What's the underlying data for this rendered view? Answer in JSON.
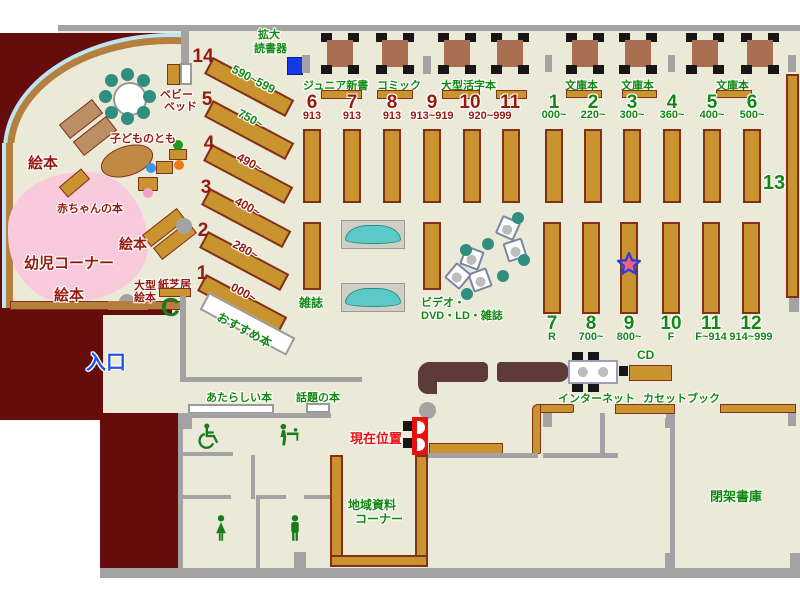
{
  "colors": {
    "background": "#EBEAD8",
    "maroon_area": "#650C0C",
    "shelf_brown": "#C9942F",
    "wall_gray": "#A3A3A3",
    "label_green": "#128812",
    "label_dark_red": "#96190F",
    "entrance_blue": "#2255EE",
    "marker_red": "#E81010",
    "kids_pink": "#F9CADB",
    "arc_light_blue": "#BFE4F4",
    "bench_teal": "#5CC9C9",
    "star_fill": "#F4617F",
    "star_outline": "#2B3FD6"
  },
  "areas": {
    "entrance": "入口",
    "kids_corner": "幼児コーナー",
    "closed_stacks": "閉架書庫",
    "local_materials_line1": "地域資料",
    "local_materials_line2": "コーナー",
    "current_location": "現在位置"
  },
  "kids": {
    "picture_books": "絵本",
    "baby_books": "赤ちゃんの本",
    "kodomo_no_tomo": "子どものとも",
    "baby_bed_line1": "ベビー",
    "baby_bed_line2": "ベッド",
    "large_picture_line1": "大型",
    "large_picture_line2": "絵本",
    "kamishibai": "紙芝居",
    "phone_mark": "C"
  },
  "shelves": {
    "magnifier_line1": "拡大",
    "magnifier_line2": "読書器",
    "junior_shinsho": "ジュニア新書",
    "comic": "コミック",
    "large_print": "大型活字本",
    "bunkobon": "文庫本",
    "magazines": "雑誌",
    "recommended": "おすすめ本",
    "video_line1": "ビデオ・",
    "video_line2": "DVD・LD・雑誌",
    "new_books": "あたらしい本",
    "topical_books": "話題の本",
    "internet": "インターネット",
    "cd": "CD",
    "cassette_books": "カセットブック",
    "shelf13": "13"
  },
  "diagonal_shelves": [
    {
      "num": "14",
      "range": "590~599"
    },
    {
      "num": "5",
      "range": "750~"
    },
    {
      "num": "4",
      "range": "490~"
    },
    {
      "num": "3",
      "range": "400~"
    },
    {
      "num": "2",
      "range": "280~"
    },
    {
      "num": "1",
      "range": "000~"
    }
  ],
  "fiction_columns": [
    {
      "num": "6",
      "range": "913"
    },
    {
      "num": "7",
      "range": "913"
    },
    {
      "num": "8",
      "range": "913"
    },
    {
      "num": "9",
      "range": "913~919"
    },
    {
      "num": "10",
      "range": "920~999"
    },
    {
      "num": "11",
      "range": ""
    }
  ],
  "nonfiction_top_columns": [
    {
      "num": "1",
      "range": "000~"
    },
    {
      "num": "2",
      "range": "220~"
    },
    {
      "num": "3",
      "range": "300~"
    },
    {
      "num": "4",
      "range": "360~"
    },
    {
      "num": "5",
      "range": "400~"
    },
    {
      "num": "6",
      "range": "500~"
    }
  ],
  "nonfiction_bottom_columns": [
    {
      "num": "7",
      "range": "R"
    },
    {
      "num": "8",
      "range": "700~"
    },
    {
      "num": "9",
      "range": "800~"
    },
    {
      "num": "10",
      "range": "F"
    },
    {
      "num": "11",
      "range": "F~914"
    },
    {
      "num": "12",
      "range": "914~999"
    }
  ]
}
